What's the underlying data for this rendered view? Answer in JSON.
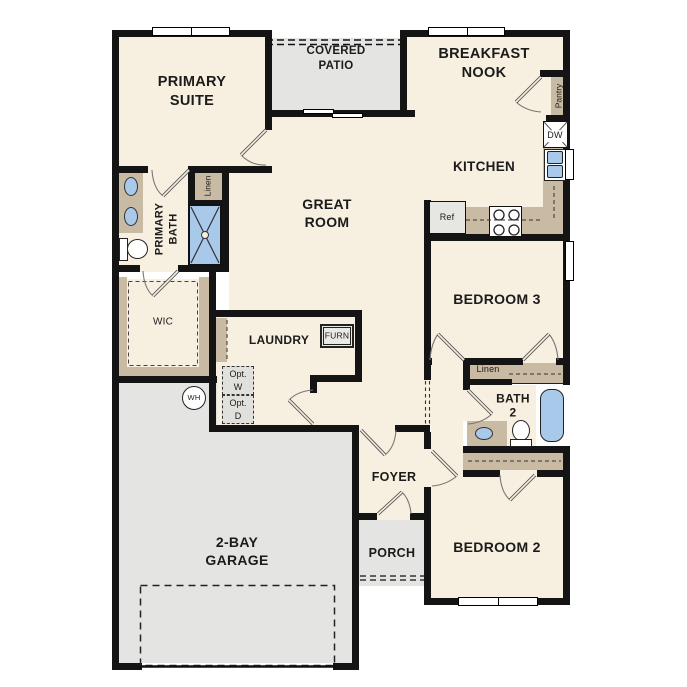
{
  "plan": {
    "rooms": {
      "primary_suite": {
        "label": "PRIMARY\nSUITE"
      },
      "covered_patio": {
        "label": "COVERED\nPATIO"
      },
      "breakfast_nook": {
        "label": "BREAKFAST\nNOOK"
      },
      "kitchen": {
        "label": "KITCHEN"
      },
      "great_room": {
        "label": "GREAT\nROOM"
      },
      "primary_bath": {
        "label": "PRIMARY\nBATH"
      },
      "wic": {
        "label": "WIC"
      },
      "laundry": {
        "label": "LAUNDRY"
      },
      "bedroom3": {
        "label": "BEDROOM 3"
      },
      "bath2": {
        "label": "BATH\n2"
      },
      "bedroom2": {
        "label": "BEDROOM 2"
      },
      "foyer": {
        "label": "FOYER"
      },
      "porch": {
        "label": "PORCH"
      },
      "garage": {
        "label": "2-BAY\nGARAGE"
      }
    },
    "fixtures": {
      "linen_primary": "Linen",
      "linen_hall": "Linen",
      "pantry": "Pantry",
      "dishwasher": "DW",
      "refrigerator": "Ref",
      "furnace": "FURN",
      "opt_washer": "Opt.\nW",
      "opt_dryer": "Opt.\nD",
      "water_heater": "WH"
    },
    "colors": {
      "wall": "#141414",
      "floor": "#F7EFE0",
      "outdoor": "#E4E4E2",
      "cabinet": "#C9BAA3",
      "fixture_blue": "#A9C9EA"
    }
  }
}
